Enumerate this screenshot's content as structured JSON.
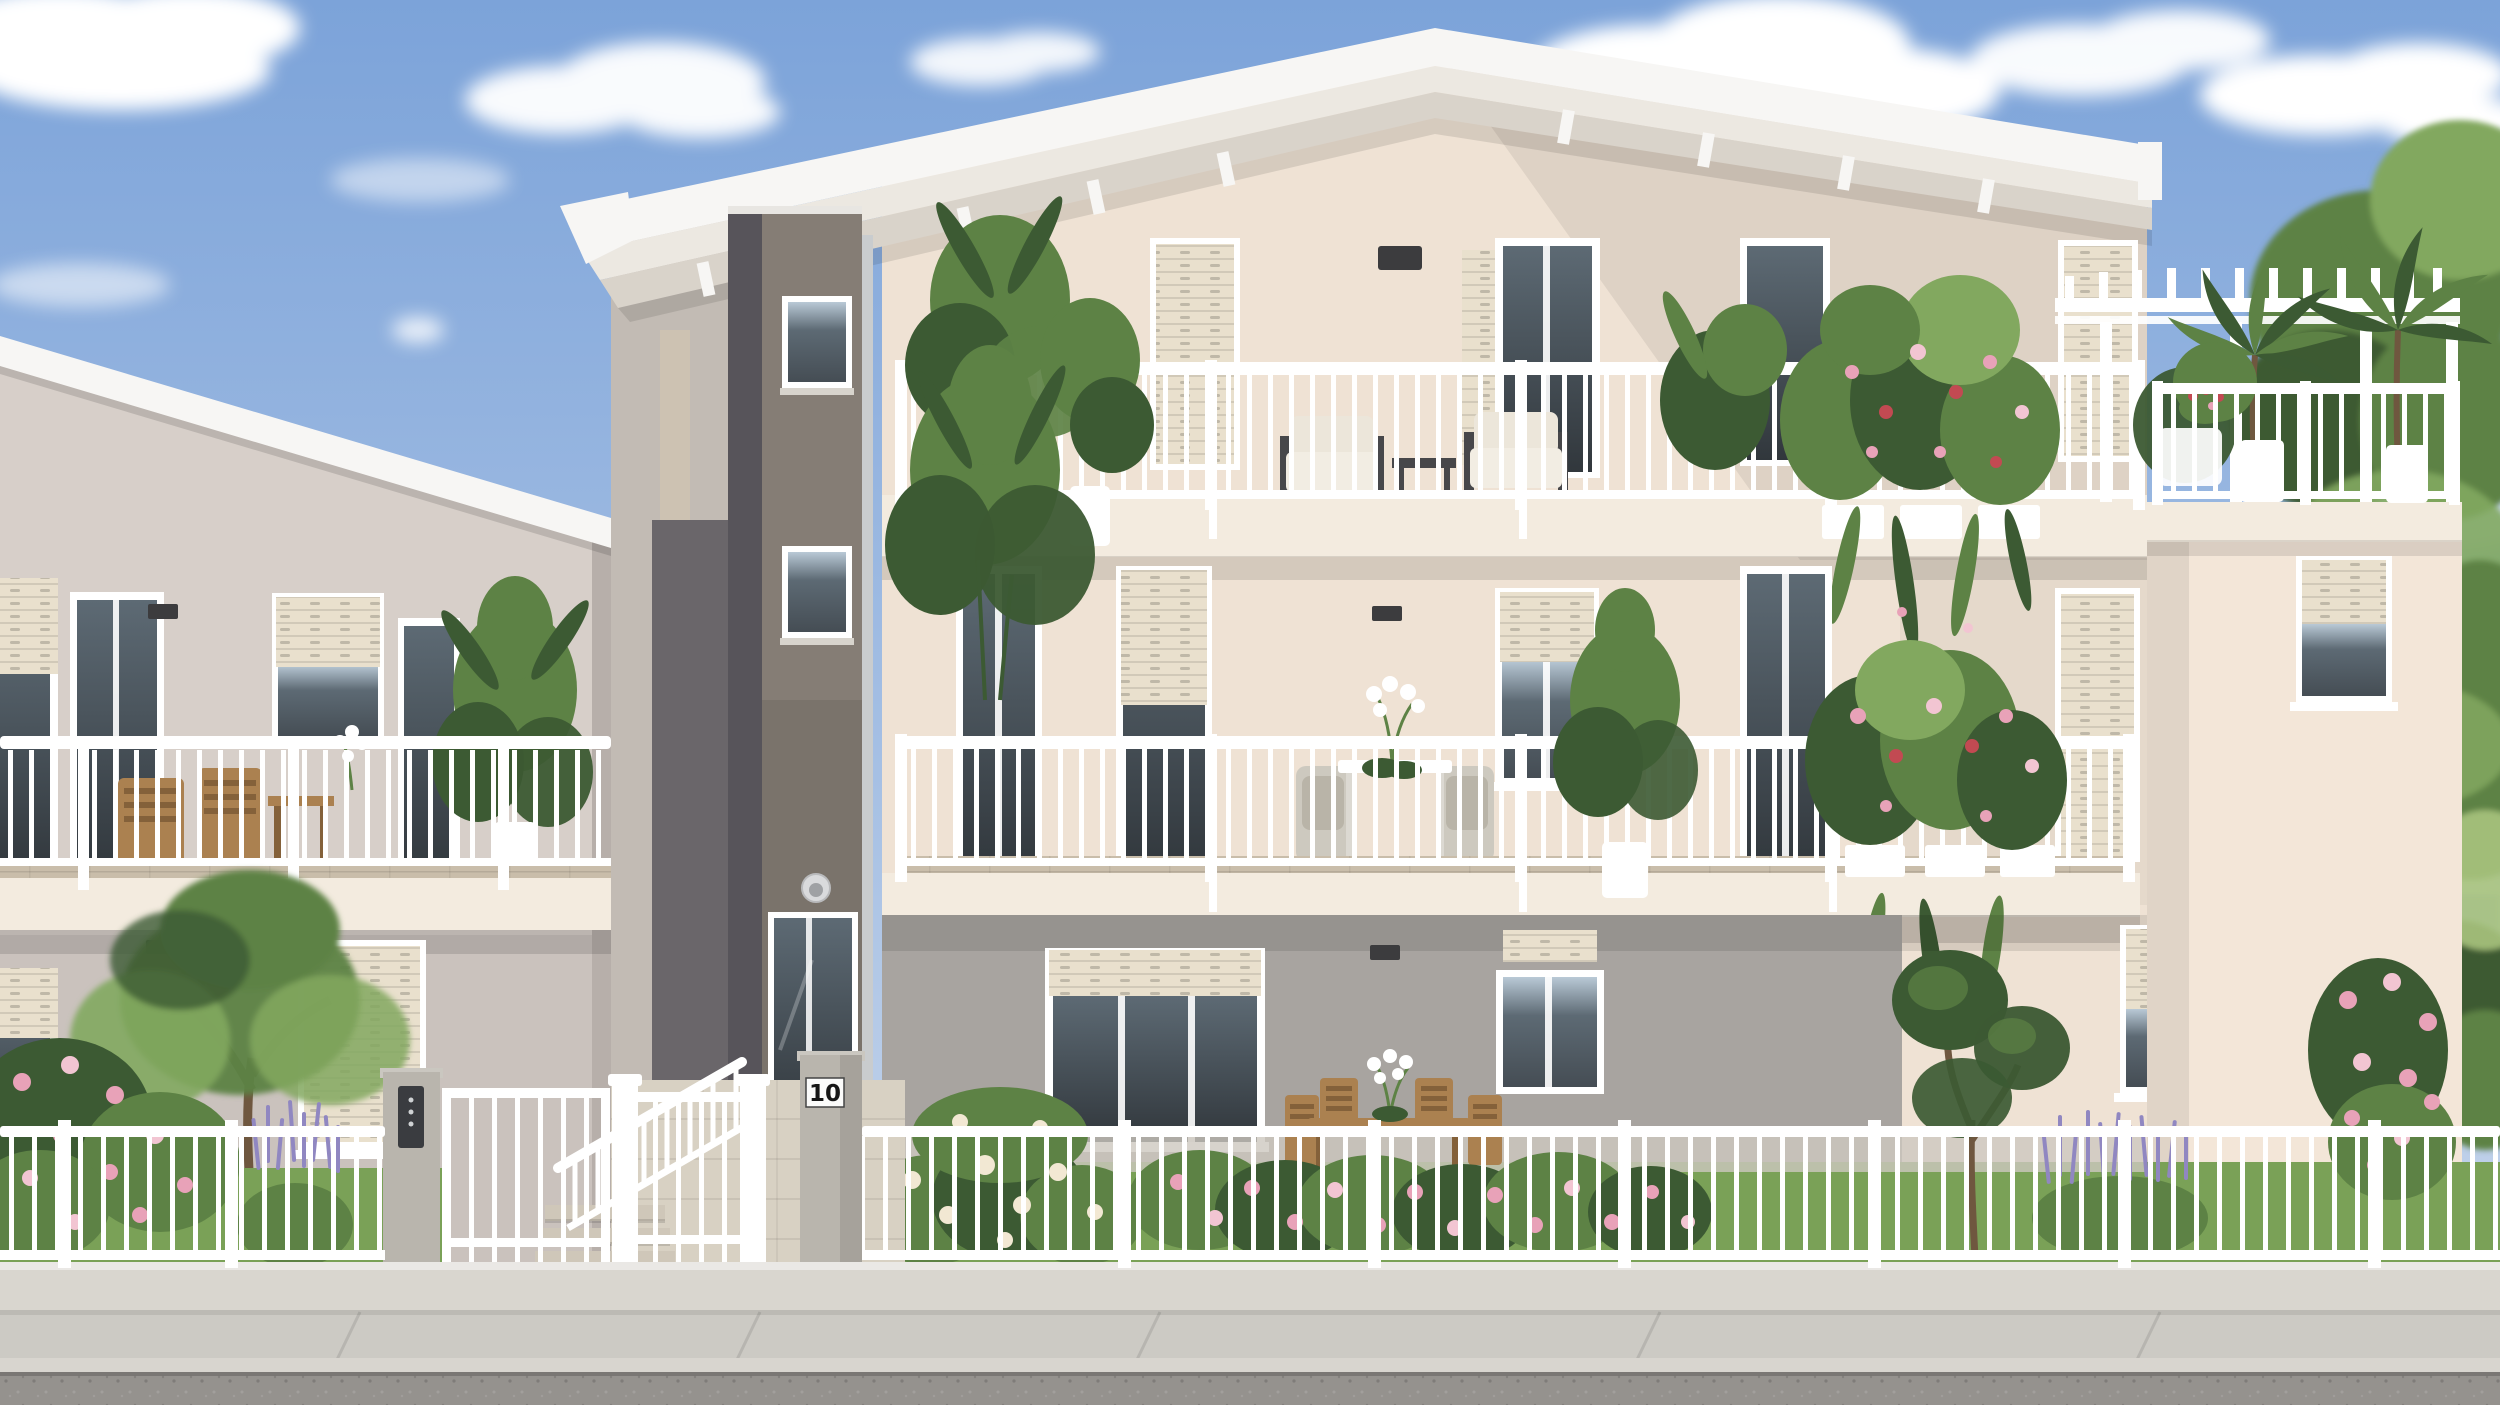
{
  "scene": {
    "type": "architectural-exterior-rendering",
    "description": "Photorealistic rendering of a modern three-storey residential building with white railings, roof terrace with pergola, balconies full of plants, a dark grey stair tower entrance, front gardens with pink flowers and lavender, a white perimeter fence, sidewalk and road, under a blue sky with cumulus clouds.",
    "house_number": "10"
  },
  "palette": {
    "sky_top": "#7ca3d9",
    "sky_mid": "#a6c0e4",
    "sky_low": "#ccd9ec",
    "cloud": "#ffffff",
    "fascia": "#f7f6f4",
    "rafter": "#ece8e1",
    "roof_under": "#d9d3ca",
    "facade": "#efe2d4",
    "facade_hi": "#f6ebdd",
    "left_facade": "#d7cfc9",
    "left_edge": "#b7afaa",
    "connect_wall": "#c2bbb4",
    "pilaster": "#cfc3b1",
    "recess": "#6a666a",
    "tower_front": "#857d75",
    "tower_side": "#57545a",
    "wing_wall": "#f3e6d8",
    "ground_gray": "#a8a4a0",
    "slab": "#f3ebdf",
    "shutter": "#e9e0cd",
    "glass_dark": "#454d54",
    "glass_mid": "#5d6a74",
    "glass_sky": "#b9c9d6",
    "white": "#ffffff",
    "deck": "#c9bdaa",
    "wood": "#ab8150",
    "wood_dark": "#84613a",
    "furn_frame": "#47474a",
    "cushion": "#ece6da",
    "wicker": "#cdc9bf",
    "grass": "#7aa157",
    "grass_dark": "#5f8643",
    "leaf_dark": "#3c5a33",
    "leaf_mid": "#5d8245",
    "leaf_light": "#82a85f",
    "leaf_pale": "#a9c37d",
    "pink": "#e8a2b8",
    "pink_light": "#f2c5d2",
    "red": "#c24a52",
    "cream_flower": "#f2e8d3",
    "lavender": "#9087c1",
    "trunk": "#6f573f",
    "pillar": "#b9b5ad",
    "concrete_base": "#d9d6cf",
    "walk": "#d8d1c3",
    "step": "#cfc7b9",
    "paving": "#cdc8bf",
    "sidewalk": "#cccac4",
    "road": "#95928e",
    "sign_bg": "#fbfbfa",
    "sign_text": "#161616",
    "intercom": "#3a3c40",
    "lamp_dark": "#3c3c3e",
    "chrome": "#d9dadc",
    "downspout": "#c9ccce",
    "blue_fence": "#7f9cc4"
  }
}
